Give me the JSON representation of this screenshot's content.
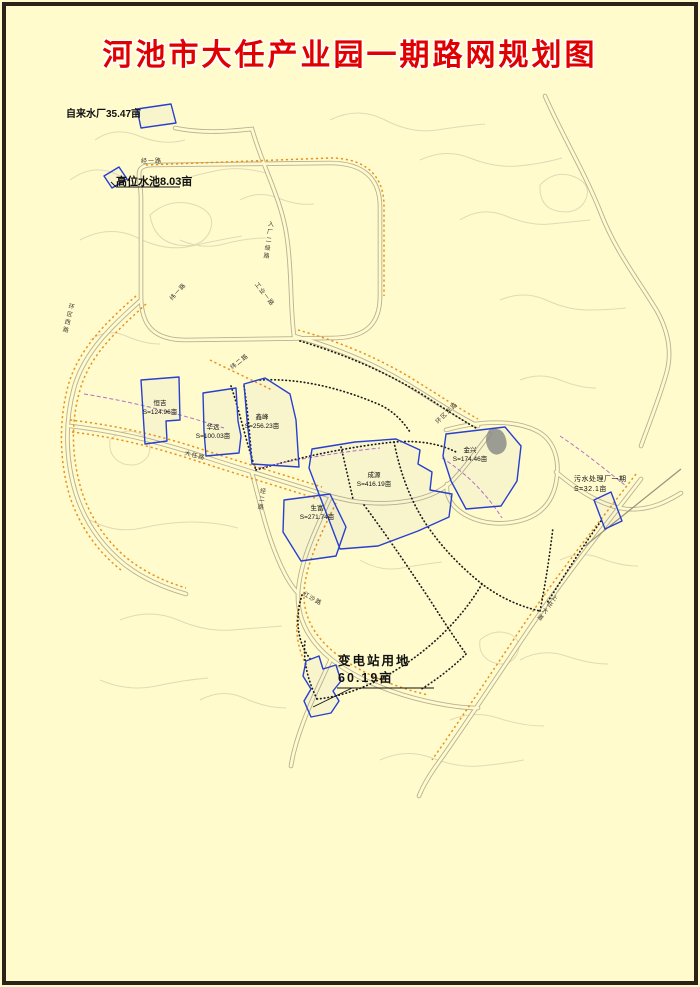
{
  "title": "河池市大任产业园一期路网规划图",
  "colors": {
    "background": "#FFFBCD",
    "border": "#2B2318",
    "title_red": "#E00000",
    "parcel_outline_blue": "#2940CE",
    "road_gray": "#B2A88E",
    "slope_hatch_orange": "#E8921E",
    "contour_tan": "#DED4B2",
    "planned_road_dotted_black": "#1C1C1C",
    "pipeline_dashed_purple": "#B472C6"
  },
  "facilities": {
    "water_plant": {
      "label": "自来水厂35.47亩"
    },
    "high_pool": {
      "label": "高位水池8.03亩"
    },
    "substation": {
      "line1": "变电站用地",
      "line2": "60.19亩"
    },
    "sewage_plant": {
      "line1": "污水处理厂一期",
      "line2": "S=32.1亩"
    }
  },
  "parcels": [
    {
      "name": "恒吉",
      "area": "S=124.96亩"
    },
    {
      "name": "华远",
      "area": "S=100.03亩"
    },
    {
      "name": "鑫峰",
      "area": "S=256.23亩"
    },
    {
      "name": "成源",
      "area": "S=416.19亩"
    },
    {
      "name": "生富",
      "area": "S=271.74亩"
    },
    {
      "name": "金兴",
      "area": "S=174.46亩"
    }
  ],
  "roads": [
    {
      "name": "经一路"
    },
    {
      "name": "入厂二级路"
    },
    {
      "name": "纬一路"
    },
    {
      "name": "工业一路"
    },
    {
      "name": "环区西路"
    },
    {
      "name": "纬二路"
    },
    {
      "name": "大任路"
    },
    {
      "name": "环区东路"
    },
    {
      "name": "经二路"
    },
    {
      "name": "红沙路"
    },
    {
      "name": "上任大道"
    }
  ]
}
